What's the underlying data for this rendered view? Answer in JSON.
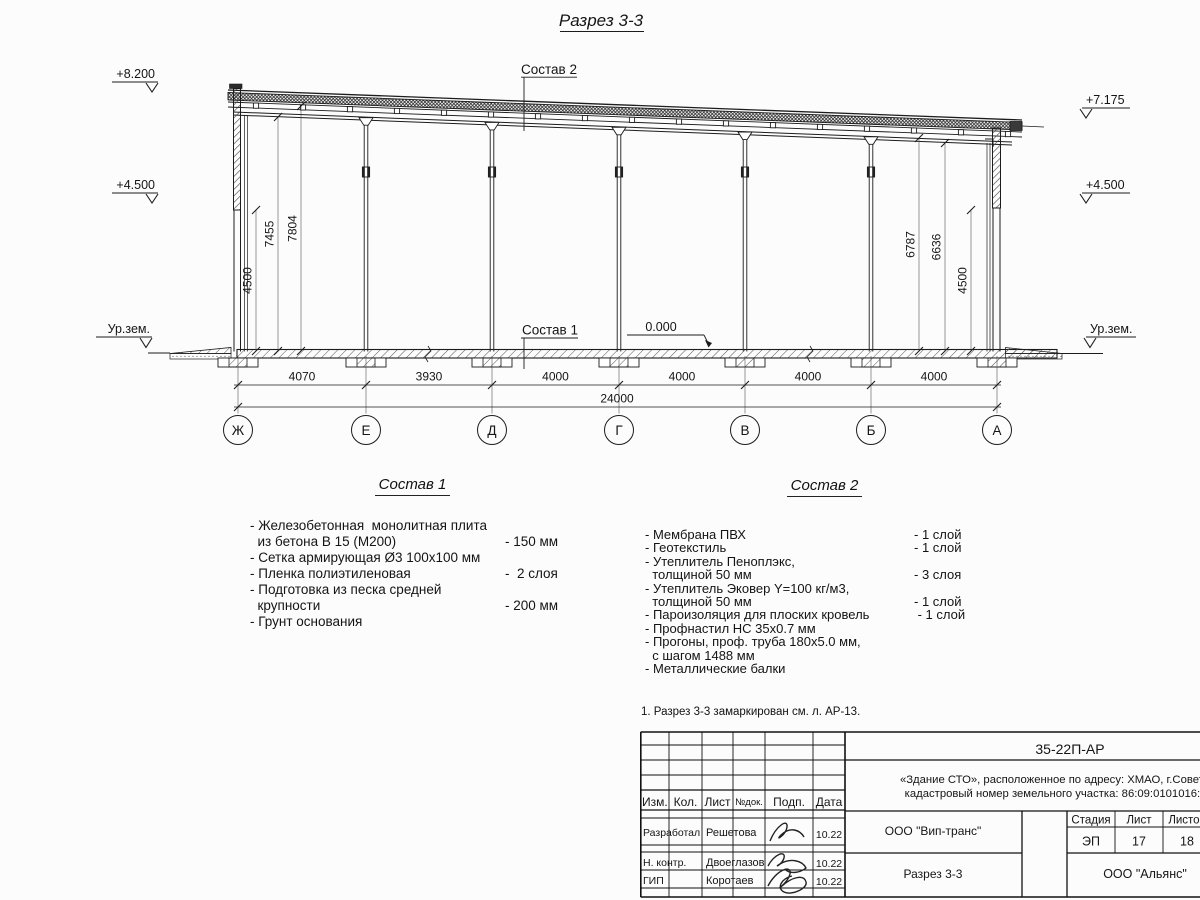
{
  "drawing": {
    "title": "Разрез 3-3",
    "labels": {
      "sostav1_ref": "Состав 1",
      "sostav2_ref": "Состав 2",
      "zero_level": "0.000"
    },
    "elevations": {
      "left_top": "+8.200",
      "left_mid": "+4.500",
      "left_ground": "Ур.зем.",
      "right_top": "+7.175",
      "right_mid": "+4.500",
      "right_ground": "Ур.зем."
    },
    "vertical_dims_left": [
      "4500",
      "7455",
      "7804"
    ],
    "vertical_dims_right": [
      "6787",
      "6636",
      "4500"
    ],
    "bottom_dims": [
      "4070",
      "3930",
      "4000",
      "4000",
      "4000",
      "4000"
    ],
    "total_dim": "24000",
    "axes": [
      "Ж",
      "Е",
      "Д",
      "Г",
      "В",
      "Б",
      "А"
    ]
  },
  "sostav1": {
    "title": "Состав 1",
    "items": [
      {
        "text": "- Железобетонная  монолитная плита\n  из бетона В 15 (М200)",
        "value": "- 150 мм"
      },
      {
        "text": "- Сетка армирующая Ø3 100х100 мм",
        "value": ""
      },
      {
        "text": "- Пленка полиэтиленовая",
        "value": "-  2 слоя"
      },
      {
        "text": "- Подготовка из песка средней\n  крупности",
        "value": "- 200 мм"
      },
      {
        "text": "- Грунт основания",
        "value": ""
      }
    ]
  },
  "sostav2": {
    "title": "Состав 2",
    "items": [
      {
        "text": "- Мембрана ПВХ",
        "value": "- 1 слой"
      },
      {
        "text": "- Геотекстиль",
        "value": "- 1 слой"
      },
      {
        "text": "- Утеплитель Пеноплэкс,\n  толщиной 50 мм",
        "value": "- 3 слоя"
      },
      {
        "text": "- Утеплитель Эковер Y=100 кг/м3,\n  толщиной 50 мм",
        "value": "- 1 слой"
      },
      {
        "text": "- Пароизоляция для плоских кровель",
        "value": " - 1 слой"
      },
      {
        "text": "- Профнастил НС 35х0.7 мм",
        "value": ""
      },
      {
        "text": "- Прогоны, проф. труба 180х5.0 мм,\n  с шагом 1488 мм",
        "value": ""
      },
      {
        "text": "- Металлические балки",
        "value": ""
      }
    ]
  },
  "note": "1. Разрез 3-3 замаркирован см. л. АР-13.",
  "titleblock": {
    "doc_code": "35-22П-АР",
    "project_line1": "«Здание СТО», расположенное по адресу: ХМАО, г.Советский,",
    "project_line2": "кадастровый номер земельного участка: 86:09:0101016:1502",
    "header_cols": [
      "Изм.",
      "Кол.",
      "Лист",
      "№док.",
      "Подп.",
      "Дата"
    ],
    "rows": [
      {
        "role": "Разработал",
        "name": "Решетова",
        "date": "10.22"
      },
      {
        "role": "Н. контр.",
        "name": "Двоеглазов",
        "date": "10.22"
      },
      {
        "role": "ГИП",
        "name": "Коротаев",
        "date": "10.22"
      }
    ],
    "org_center": "ООО \"Вип-транс\"",
    "drawing_title": "Разрез 3-3",
    "org_right": "ООО \"Альянс\"",
    "stage_cols": [
      "Стадия",
      "Лист",
      "Листов"
    ],
    "stage_values": [
      "ЭП",
      "17",
      "18"
    ]
  }
}
